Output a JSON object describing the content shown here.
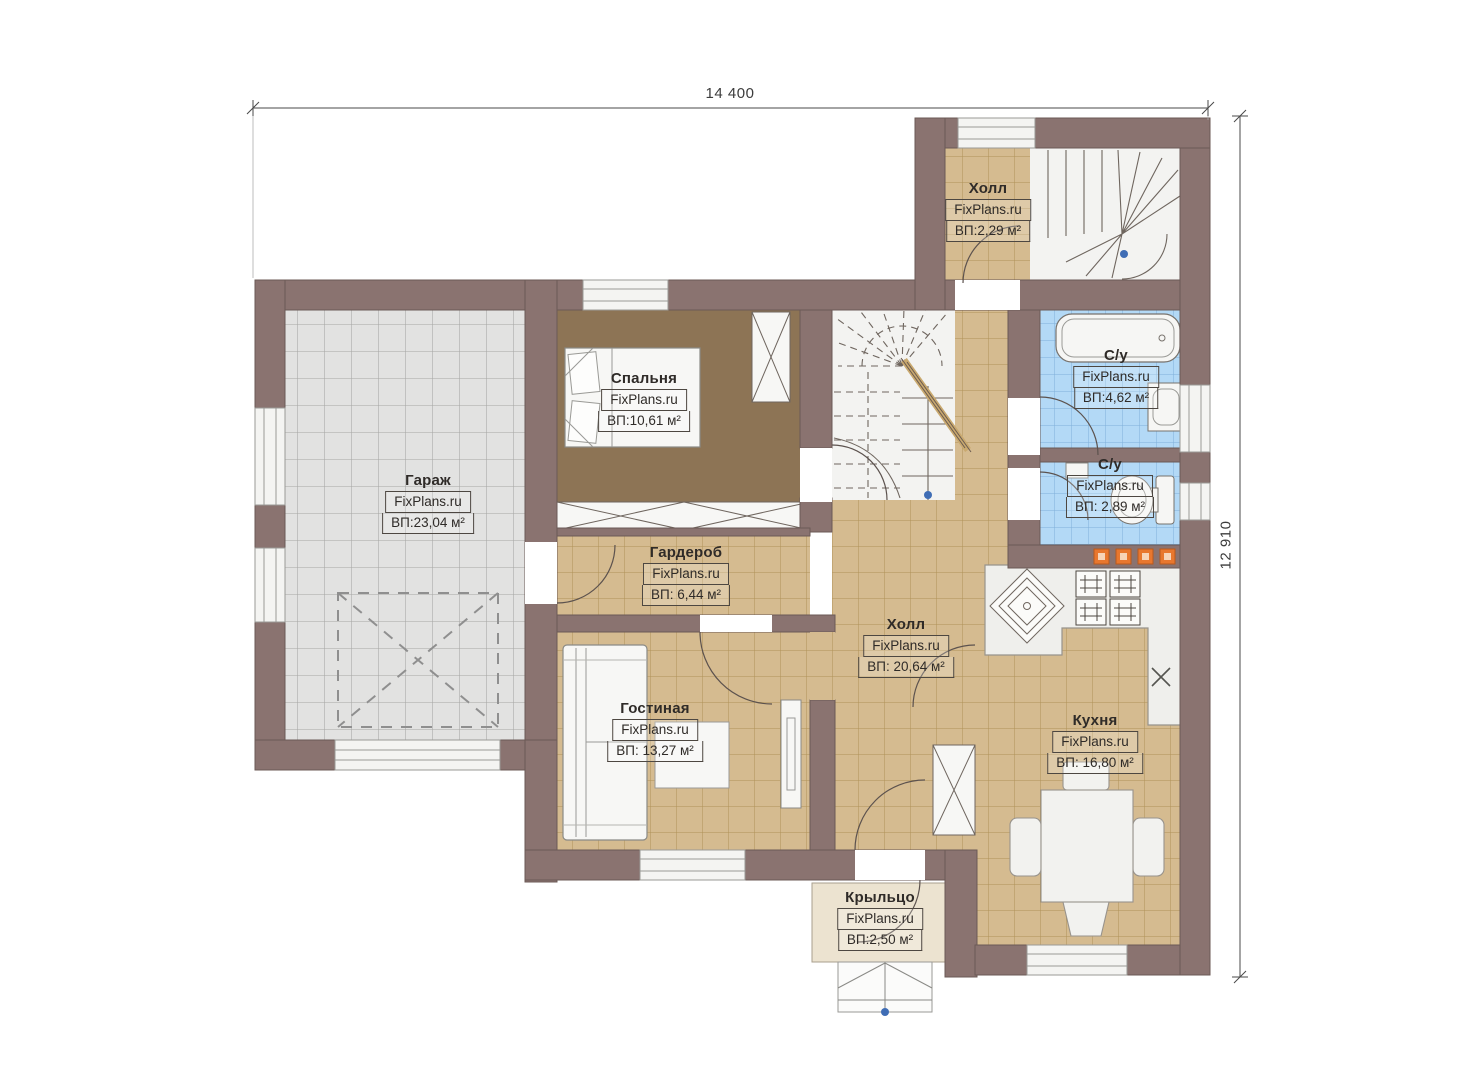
{
  "dimensions": {
    "width_label": "14 400",
    "height_label": "12 910"
  },
  "rooms": [
    {
      "id": "hall-top",
      "name": "Холл",
      "watermark": "FixPlans.ru",
      "area": "ВП:2,29 м²"
    },
    {
      "id": "bathroom-1",
      "name": "С/у",
      "watermark": "FixPlans.ru",
      "area": "ВП:4,62 м²"
    },
    {
      "id": "bathroom-2",
      "name": "С/у",
      "watermark": "FixPlans.ru",
      "area": "ВП: 2,89 м²"
    },
    {
      "id": "garage",
      "name": "Гараж",
      "watermark": "FixPlans.ru",
      "area": "ВП:23,04 м²"
    },
    {
      "id": "bedroom",
      "name": "Спальня",
      "watermark": "FixPlans.ru",
      "area": "ВП:10,61 м²"
    },
    {
      "id": "wardrobe",
      "name": "Гардероб",
      "watermark": "FixPlans.ru",
      "area": "ВП: 6,44 м²"
    },
    {
      "id": "living-room",
      "name": "Гостиная",
      "watermark": "FixPlans.ru",
      "area": "ВП: 13,27 м²"
    },
    {
      "id": "hall-main",
      "name": "Холл",
      "watermark": "FixPlans.ru",
      "area": "ВП: 20,64 м²"
    },
    {
      "id": "kitchen",
      "name": "Кухня",
      "watermark": "FixPlans.ru",
      "area": "ВП: 16,80 м²"
    },
    {
      "id": "porch",
      "name": "Крыльцо",
      "watermark": "FixPlans.ru",
      "area": "ВП:2,50 м²"
    }
  ],
  "colors": {
    "wall": "#8a7370",
    "tile": "#d5bb90",
    "bathroom_tile": "#b3d9f6",
    "garage_tile": "#e2e2e1",
    "bedroom_floor": "#8d7455",
    "porch_floor": "#ece3d0",
    "accent_orange": "#e8772e",
    "marker_blue": "#3f6db5"
  }
}
